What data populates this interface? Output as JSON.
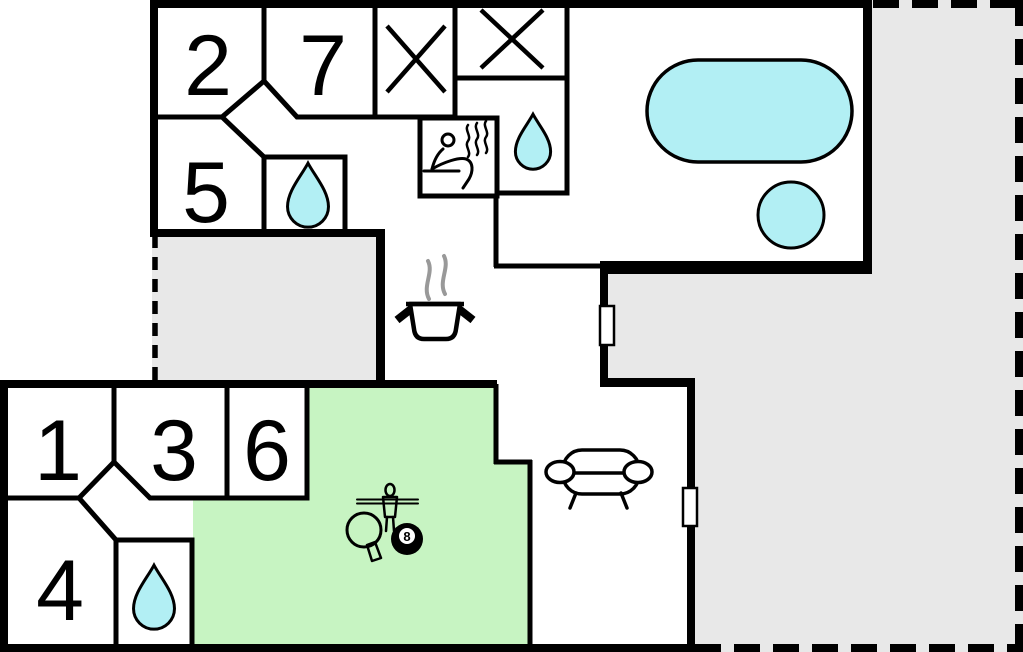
{
  "plan": {
    "type": "holiday-house-floor-plan",
    "rooms": {
      "r1": "1",
      "r2": "2",
      "r3": "3",
      "r4": "4",
      "r5": "5",
      "r6": "6",
      "r7": "7"
    },
    "game_room": {
      "eight_ball_label": "8"
    },
    "colors": {
      "wall": "#000000",
      "terrace_fill": "#e8e8e8",
      "game_room_fill": "#c7f4c2",
      "water_fill": "#b2eff4",
      "steam_gray": "#999999",
      "background": "#ffffff"
    },
    "icons": [
      "water-drop-icon",
      "sauna-icon",
      "crossed-out-icon",
      "cooking-pot-icon",
      "sofa-icon",
      "foosball-player-icon",
      "table-tennis-paddle-icon",
      "eight-ball-icon"
    ]
  }
}
